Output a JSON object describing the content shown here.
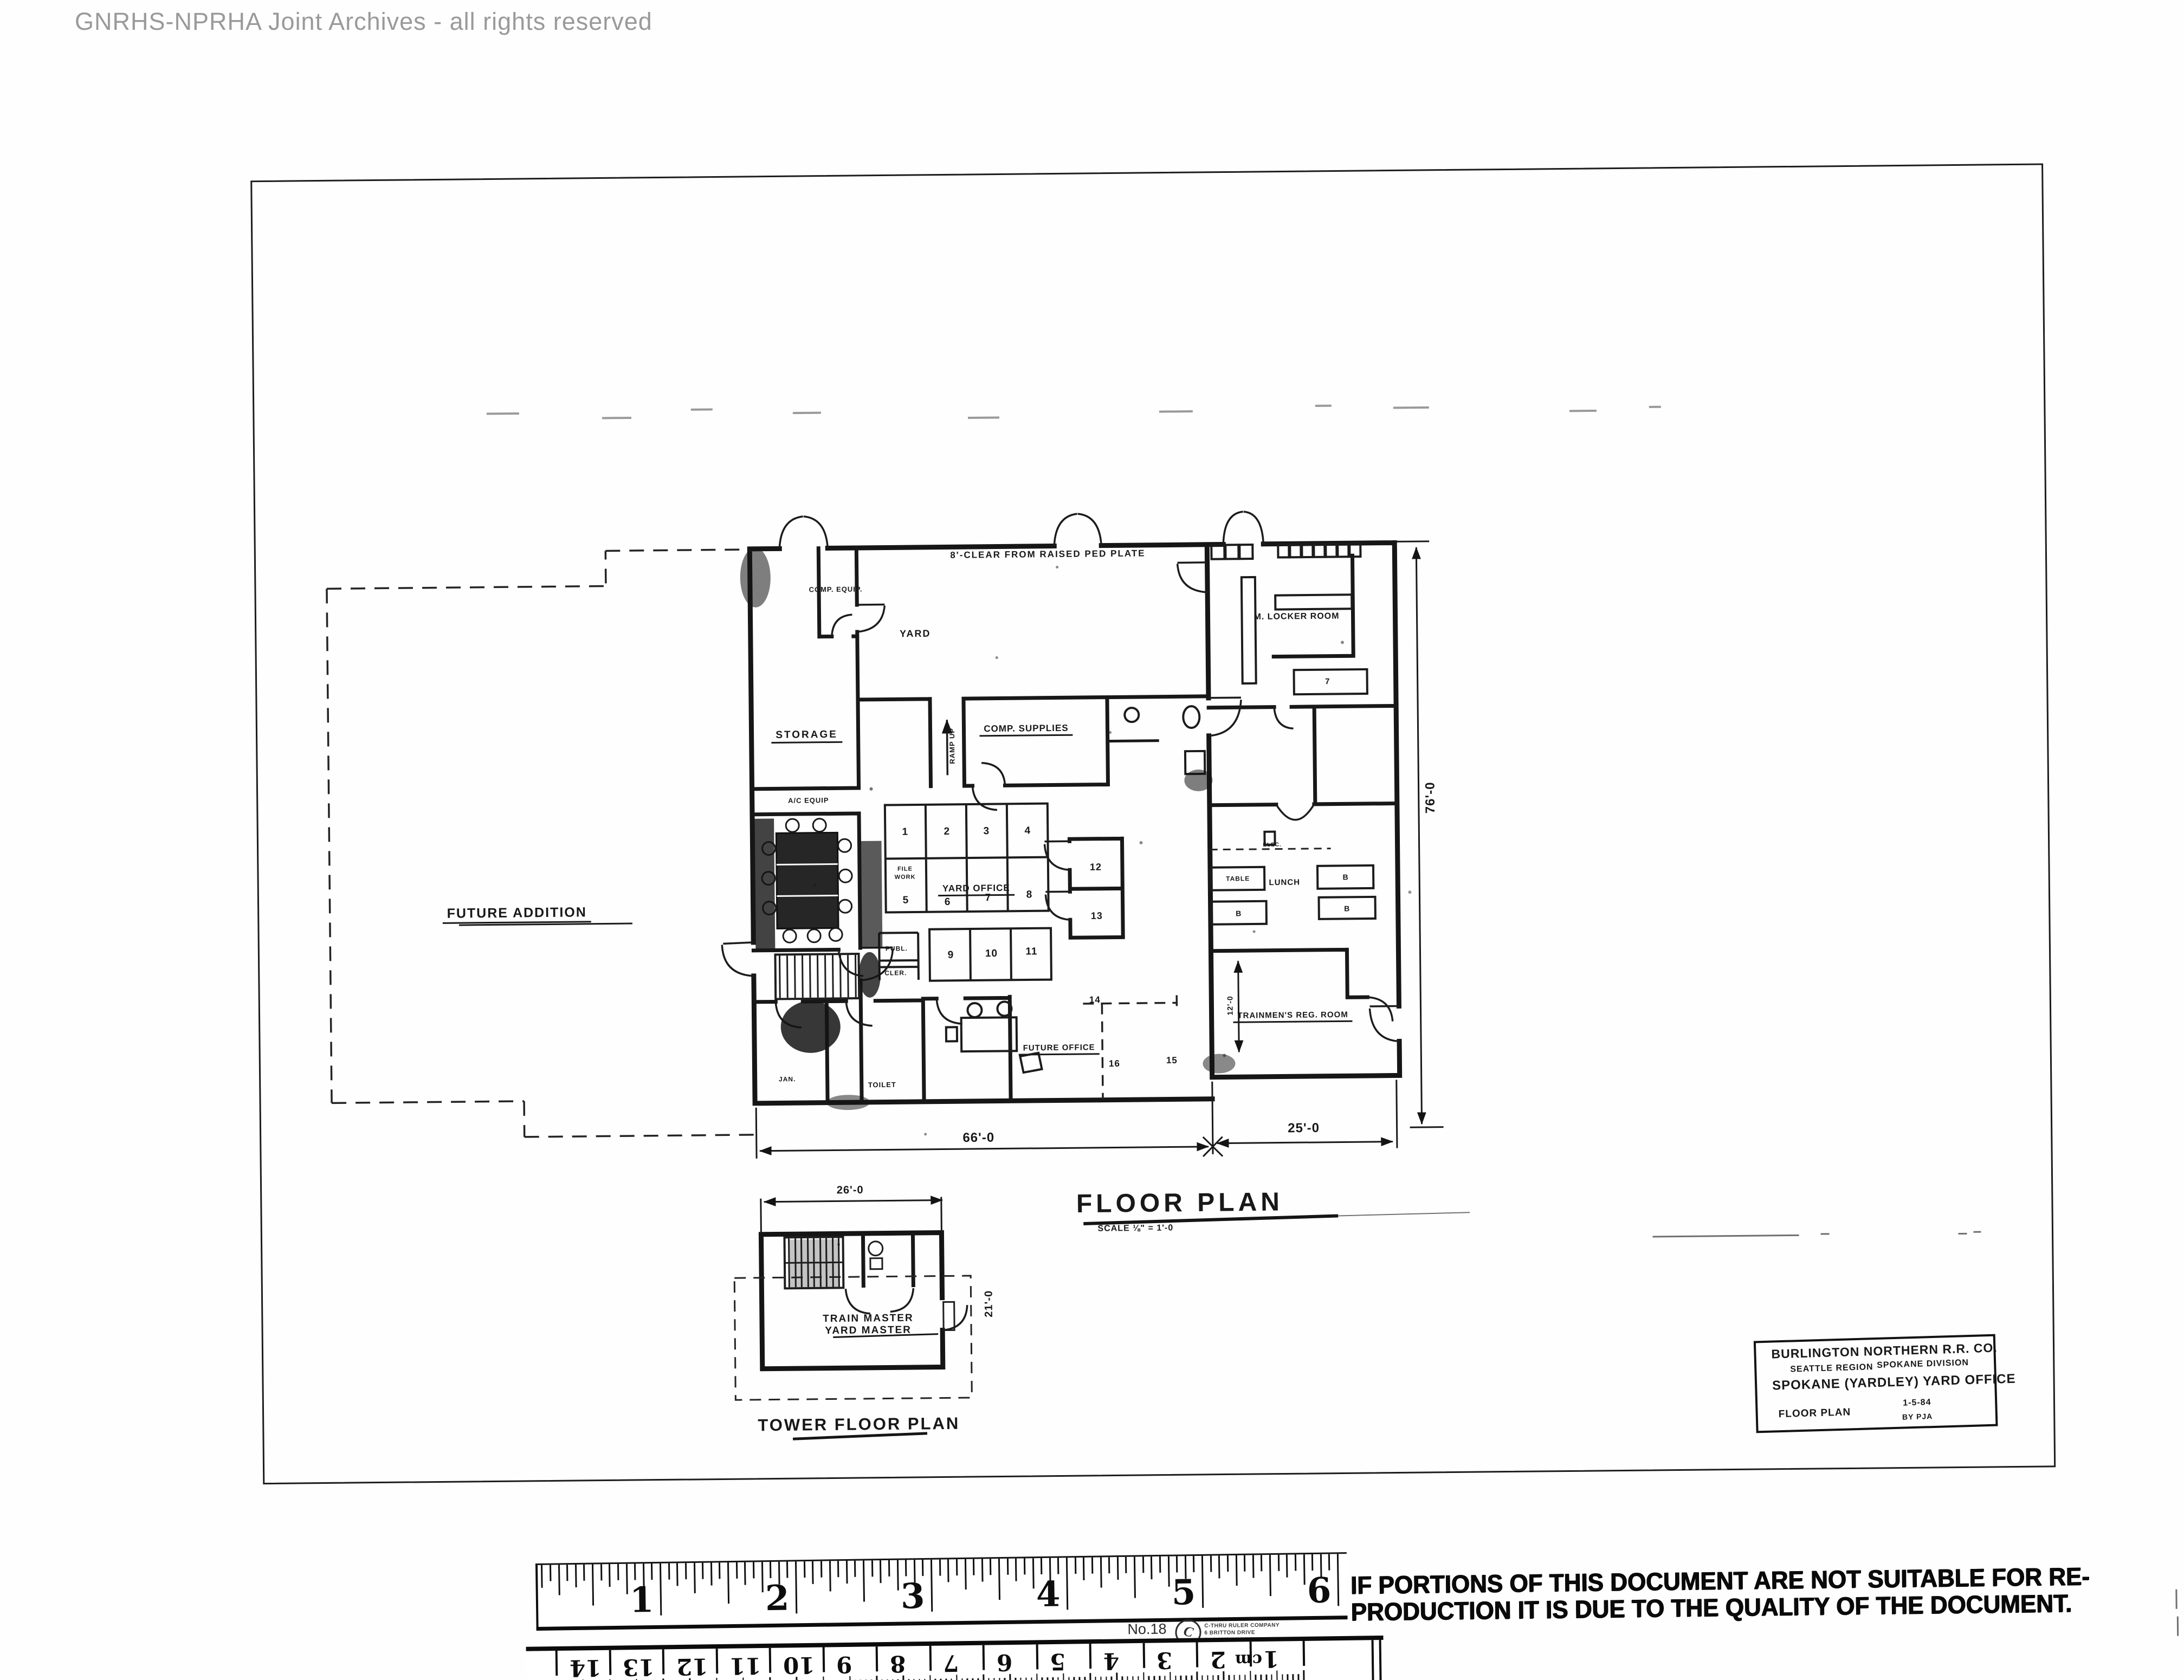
{
  "watermark": "GNRHS-NPRHA Joint Archives - all rights reserved",
  "fp": {
    "note_top": "8'-CLEAR FROM RAISED PED PLATE",
    "future_addition": "FUTURE ADDITION",
    "storage": "STORAGE",
    "comp_equip": "COMP. EQUIP.",
    "yard": "YARD",
    "comp_supplies": "COMP. SUPPLIES",
    "ramp_up": "RAMP UP",
    "ac_equip": "A/C EQUIP",
    "m_locker_room": "M. LOCKER ROOM",
    "yard_office": "YARD OFFICE",
    "file": "FILE",
    "work": "WORK",
    "publ": "PUBL.",
    "cler": "CLER.",
    "lunch": "LUNCH",
    "elec": "ELEC.",
    "table": "TABLE",
    "bench": "B",
    "room7": "7",
    "trainmens": "TRAINMEN'S REG. ROOM",
    "future_office": "FUTURE OFFICE",
    "jan": "JAN.",
    "toilet": "TOILET",
    "desks": [
      "1",
      "2",
      "3",
      "4",
      "5",
      "6",
      "7",
      "8",
      "9",
      "10",
      "11",
      "12",
      "13",
      "14",
      "15",
      "16"
    ],
    "dim_main": "66'-0",
    "dim_wing": "25'-0",
    "dim_depth": "76'-0",
    "dim_reg": "12'-0",
    "title": "FLOOR PLAN",
    "scale": "SCALE ⅛\" = 1'-0"
  },
  "tower": {
    "dim_width": "26'-0",
    "dim_depth": "21'-0",
    "label1": "TRAIN MASTER",
    "label2": "YARD MASTER",
    "title": "TOWER FLOOR PLAN"
  },
  "title_block": {
    "company": "BURLINGTON NORTHERN R.R. CO.",
    "region": "SEATTLE REGION",
    "division": "SPOKANE DIVISION",
    "project": "SPOKANE (YARDLEY) YARD OFFICE",
    "sheet": "FLOOR PLAN",
    "date": "1-5-84",
    "by": "BY PJA"
  },
  "stamp": {
    "line1": "IF PORTIONS OF THIS DOCUMENT ARE NOT SUITABLE FOR RE-",
    "line2": "PRODUCTION IT IS DUE TO THE QUALITY OF THE DOCUMENT."
  },
  "ruler": {
    "model": "No.18",
    "logo_letter": "C",
    "brand_line1": "C-THRU RULER COMPANY",
    "brand_line2": "6 BRITTON DRIVE",
    "brand_line3": "BLOOMFIELD CONN. U.S.A.",
    "inch_numbers": [
      "1",
      "2",
      "3",
      "4",
      "5",
      "6"
    ],
    "cm_numbers": [
      "1",
      "2",
      "3",
      "4",
      "5",
      "6",
      "7",
      "8",
      "9",
      "10",
      "11",
      "12",
      "13",
      "14",
      "15"
    ],
    "cm_unit": "cm"
  }
}
